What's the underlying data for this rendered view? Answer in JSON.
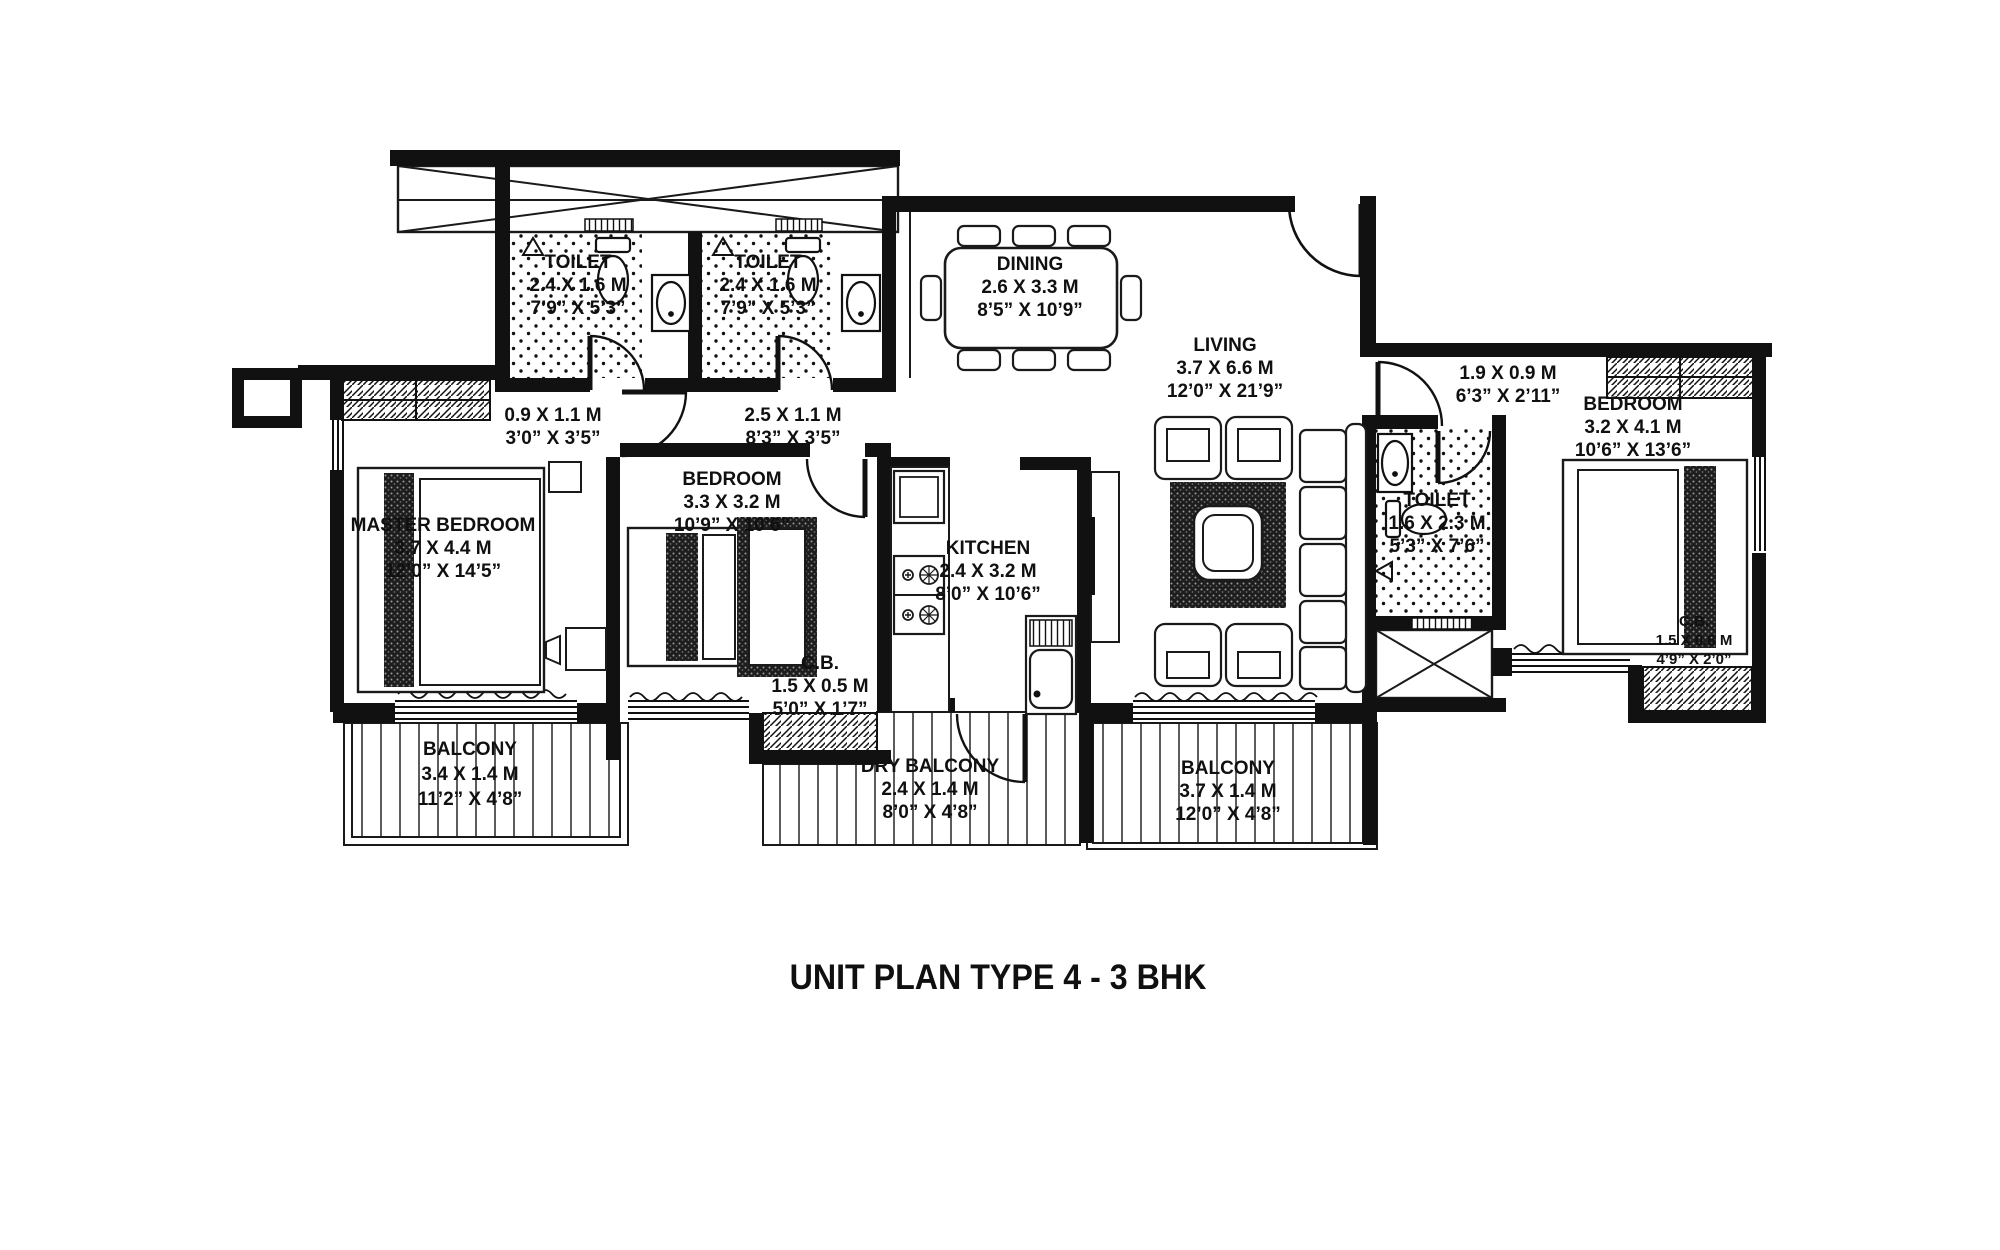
{
  "title": "UNIT PLAN TYPE 4 - 3 BHK",
  "rooms": {
    "toilet_1": {
      "name": "TOILET",
      "metric": "2.4 X 1.6 M",
      "imperial": "7’9” X 5’3”"
    },
    "toilet_2": {
      "name": "TOILET",
      "metric": "2.4 X 1.6 M",
      "imperial": "7’9” X 5’3”"
    },
    "dining": {
      "name": "DINING",
      "metric": "2.6 X 3.3 M",
      "imperial": "8’5” X 10’9”"
    },
    "living": {
      "name": "LIVING",
      "metric": "3.7 X 6.6 M",
      "imperial": "12’0” X 21’9”"
    },
    "lobby_small": {
      "metric": "0.9 X 1.1 M",
      "imperial": "3’0” X 3’5”"
    },
    "lobby": {
      "metric": "2.5 X 1.1 M",
      "imperial": "8’3” X 3’5”"
    },
    "entry_passage": {
      "metric": "1.9 X 0.9 M",
      "imperial": "6’3” X 2’11”"
    },
    "master_bedroom": {
      "name": "MASTER BEDROOM",
      "metric": "3.7 X 4.4 M",
      "imperial": "12’0” X 14’5”"
    },
    "bedroom_2": {
      "name": "BEDROOM",
      "metric": "3.3 X 3.2 M",
      "imperial": "10’9” X 10’6”"
    },
    "bedroom_3": {
      "name": "BEDROOM",
      "metric": "3.2 X 4.1 M",
      "imperial": "10’6” X 13’6”"
    },
    "kitchen": {
      "name": "KITCHEN",
      "metric": "2.4 X 3.2 M",
      "imperial": "8’0” X 10’6”"
    },
    "toilet_3": {
      "name": "TOILET",
      "metric": "1.6 X 2.3 M",
      "imperial": "5’3” X 7’6”"
    },
    "cb_1": {
      "name": "C.B.",
      "metric": "1.5 X 0.5 M",
      "imperial": "5’0” X 1’7”"
    },
    "cb_2": {
      "name": "C.B.",
      "metric": "1.5 X 0.6 M",
      "imperial": "4’9” X 2’0”"
    },
    "balcony_1": {
      "name": "BALCONY",
      "metric": "3.4 X 1.4 M",
      "imperial": "11’2” X 4’8”"
    },
    "dry_balcony": {
      "name": "DRY BALCONY",
      "metric": "2.4 X 1.4 M",
      "imperial": "8’0” X 4’8”"
    },
    "balcony_2": {
      "name": "BALCONY",
      "metric": "3.7 X 1.4 M",
      "imperial": "12’0” X 4’8”"
    }
  },
  "colors": {
    "wall": "#111111",
    "line": "#1a1a1a",
    "background": "#ffffff"
  }
}
